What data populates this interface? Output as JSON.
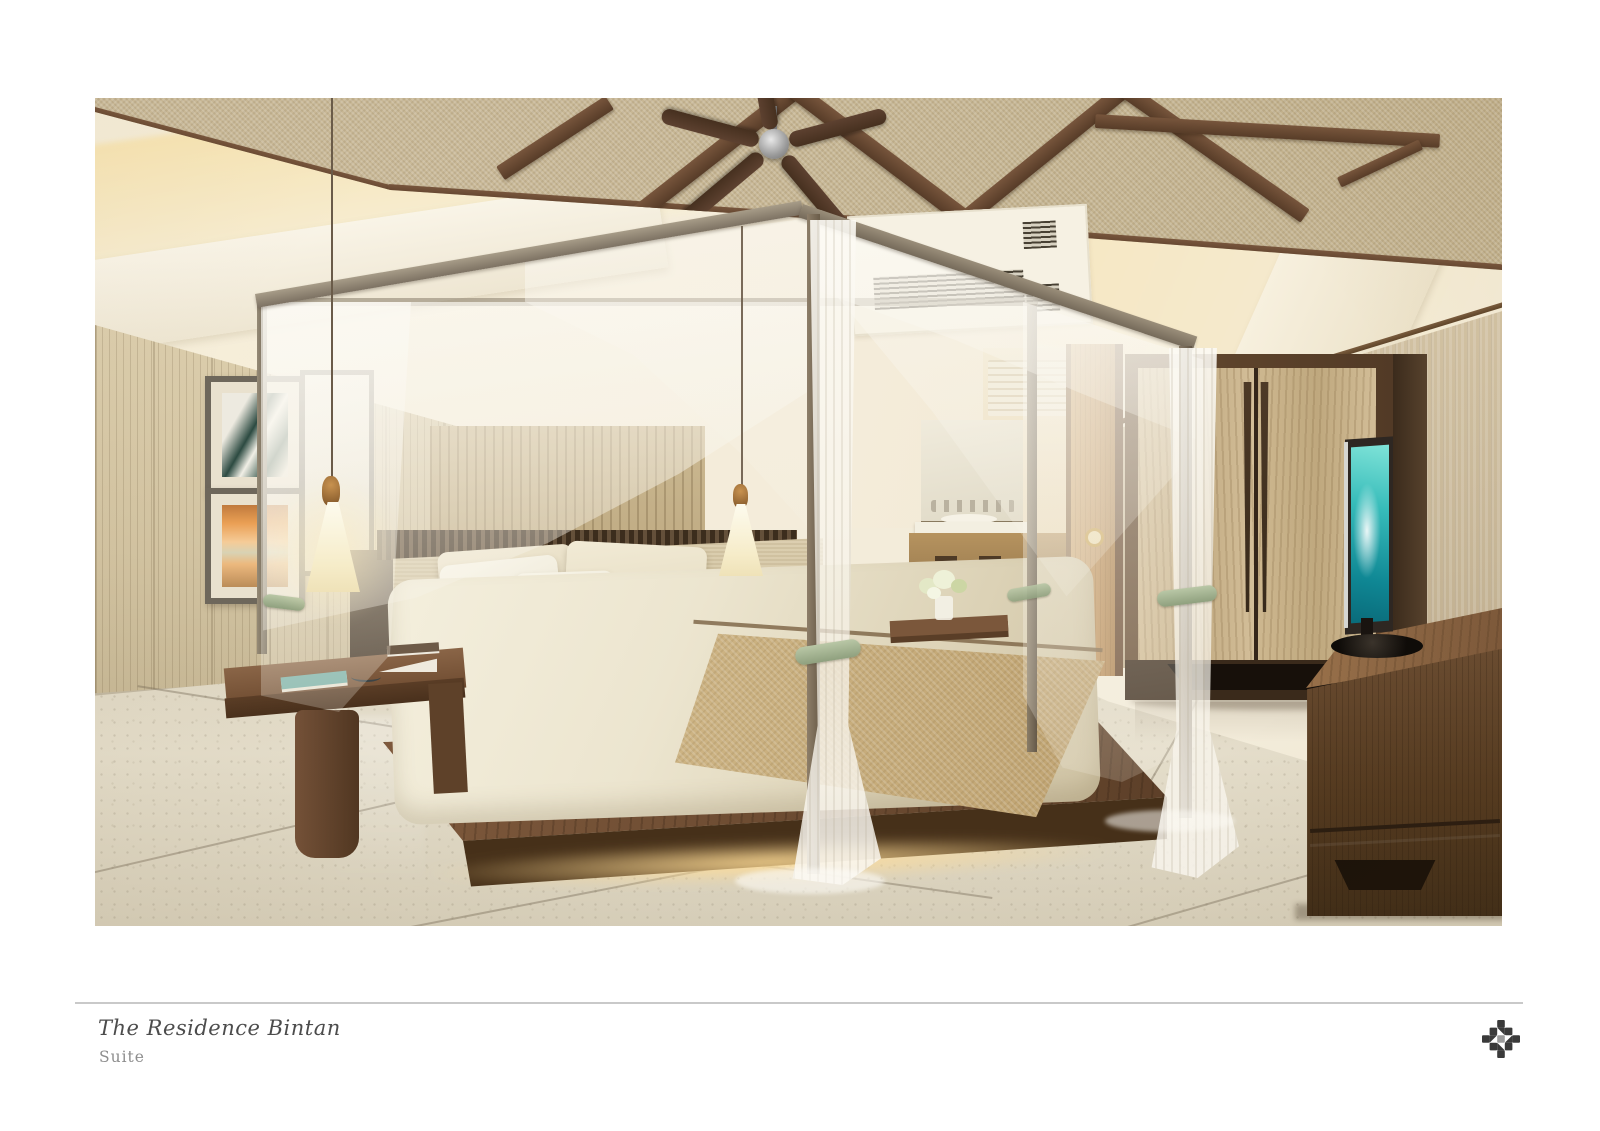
{
  "caption": {
    "title": "The Residence Bintan",
    "subtitle": "Suite"
  },
  "image": {
    "alt": "Architectural rendering of the Suite bedroom: a four-poster canopy bed with sheer white drapes tied with sage ribbons, glowing pendant lamps, exposed dark-timber roof trusses with a ceiling fan, framed artwork on a beige panelled wall, a light-oak wardrobe, a dark-wood TV console with a flat-screen TV showing a teal image, a sliding door to a bathroom vanity with rolled towels, and a speckled terrazzo floor."
  },
  "logo": {
    "name": "residence-mosaic-logo"
  },
  "palette": {
    "page_background": "#ffffff",
    "divider": "#c9c9c9",
    "title_text": "#4c4c4c",
    "subtitle_text": "#8d8d8d",
    "logo_dark": "#3a3a3a",
    "logo_center": "#9b9b9b",
    "ceiling_tan": "#c7b795",
    "beam_wood": "#5e4230",
    "wall_beige": "#d5c6a5",
    "wallpaper_right": "#cdbda0",
    "wood_dark": "#5b4330",
    "wardrobe_oak": "#c6b08c",
    "floor_terrazzo": "#ddd5c1",
    "curtain_white": "#faf7ef",
    "tie_sage": "#a9bc9c",
    "bolster_olive": "#8f8f6d",
    "throw_tan": "#c8af7e",
    "tv_screen_teal": "#2db3b2",
    "glow_warm": "#ffdf9d",
    "sunset_art_orange": "#ea9f54",
    "leaf_art_green": "#2c4a41"
  }
}
